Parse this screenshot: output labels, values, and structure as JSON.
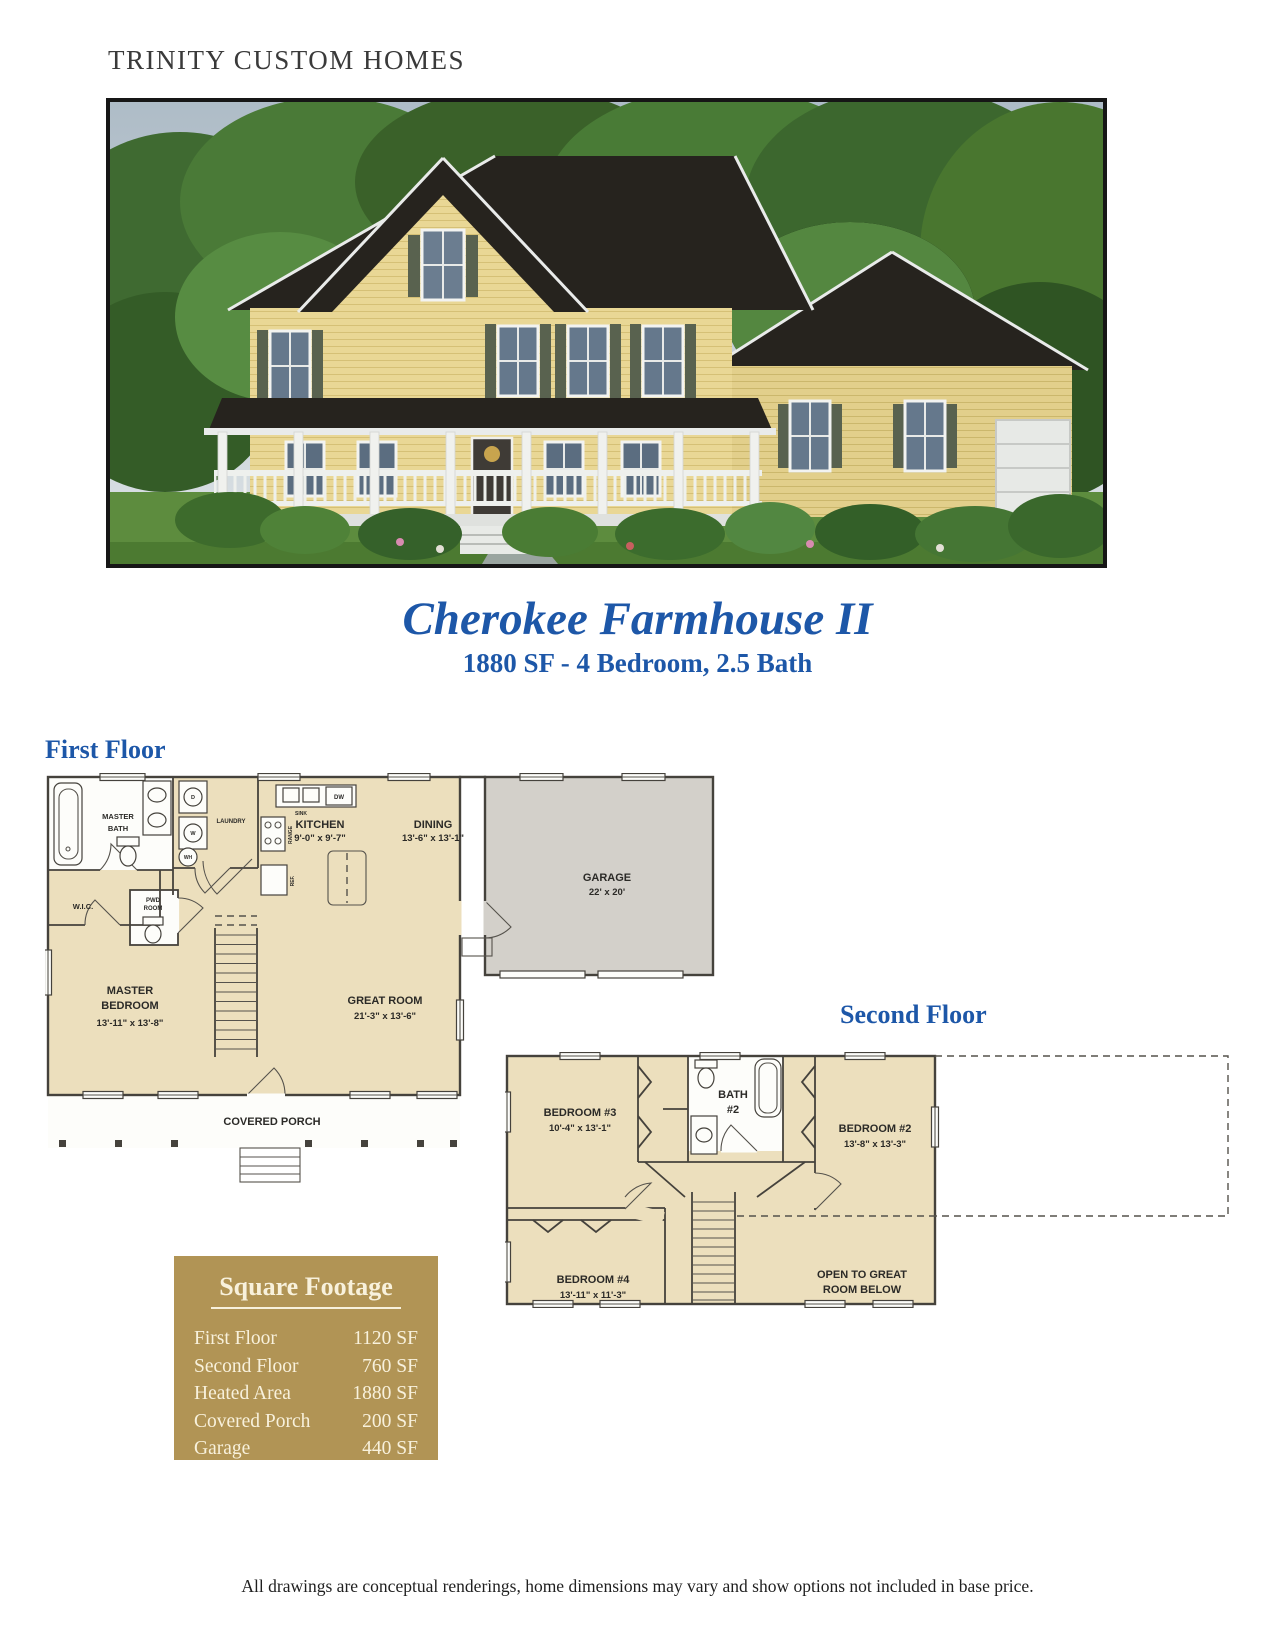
{
  "page": {
    "brand": "TRINITY CUSTOM HOMES",
    "footer": "All drawings are conceptual renderings, home dimensions may vary and show options not included in base price."
  },
  "title": {
    "name": "Cherokee Farmhouse II",
    "specs": "1880 SF - 4 Bedroom, 2.5 Bath"
  },
  "first_floor": {
    "heading": "First Floor",
    "master_bath_l1": "MASTER",
    "master_bath_l2": "BATH",
    "laundry": "LAUNDRY",
    "kitchen": "KITCHEN",
    "kitchen_dims": "9'-0\" x 9'-7\"",
    "dining": "DINING",
    "dining_dims": "13'-6\" x 13'-1\"",
    "garage": "GARAGE",
    "garage_dims": "22' x 20'",
    "wic": "W.I.C.",
    "pwd_l1": "PWD",
    "pwd_l2": "ROOM",
    "master_bedroom_l1": "MASTER",
    "master_bedroom_l2": "BEDROOM",
    "master_bedroom_dims": "13'-11\" x 13'-8\"",
    "great_room": "GREAT ROOM",
    "great_room_dims": "21'-3\" x 13'-6\"",
    "covered_porch": "COVERED PORCH",
    "fx_sink": "SINK",
    "fx_dw": "DW",
    "fx_range": "RANGE",
    "fx_ref": "REF.",
    "fx_wh": "WH",
    "fx_d": "D",
    "fx_w": "W"
  },
  "second_floor": {
    "heading": "Second Floor",
    "bedroom3": "BEDROOM #3",
    "bedroom3_dims": "10'-4\" x 13'-1\"",
    "bath2_l1": "BATH",
    "bath2_l2": "#2",
    "bedroom2": "BEDROOM #2",
    "bedroom2_dims": "13'-8\" x 13'-3\"",
    "bedroom4": "BEDROOM #4",
    "bedroom4_dims": "13'-11\" x 11'-3\"",
    "open_l1": "OPEN TO GREAT",
    "open_l2": "ROOM BELOW"
  },
  "square_footage": {
    "title": "Square Footage",
    "rows": [
      {
        "label": "First Floor",
        "value": "1120 SF"
      },
      {
        "label": "Second Floor",
        "value": "760 SF"
      },
      {
        "label": "Heated Area",
        "value": "1880 SF"
      },
      {
        "label": "Covered Porch",
        "value": "200 SF"
      },
      {
        "label": "Garage",
        "value": "440 SF"
      }
    ]
  },
  "colors": {
    "accent_blue": "#1d57a8",
    "plan_fill": "#ecdfbd",
    "garage_fill": "#d3d0ca",
    "table_gold": "#b19455",
    "wall": "#45423c"
  }
}
